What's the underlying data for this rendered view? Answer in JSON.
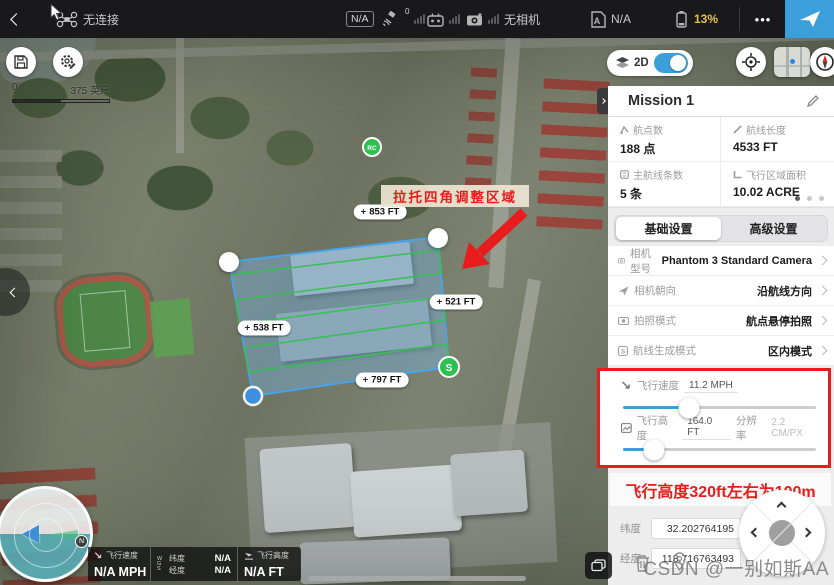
{
  "top_bar": {
    "connection": "无连接",
    "mode_badge": "N/A",
    "gps_count": "0",
    "camera_status": "无相机",
    "flight_mode": "N/A",
    "battery": "13%",
    "more": "•••"
  },
  "map": {
    "scale_start": "0",
    "scale_end": "375 英尺",
    "toggle_2d": "2D",
    "move_icon": "+",
    "labels": {
      "top": "853 FT",
      "right": "521 FT",
      "left": "538 FT",
      "bottom": "797 FT"
    },
    "annotation": "拉托四角调整区域",
    "rc_marker": "RC",
    "start_marker": "S",
    "north_badge": "N"
  },
  "panel": {
    "mission_title": "Mission 1",
    "stats": [
      {
        "label": "航点数",
        "value": "188 点"
      },
      {
        "label": "航线长度",
        "value": "4533 FT"
      },
      {
        "label": "主航线条数",
        "value": "5 条"
      },
      {
        "label": "飞行区域面积",
        "value": "10.02 ACRE"
      }
    ],
    "tabs": [
      {
        "label": "基础设置"
      },
      {
        "label": "高级设置"
      }
    ],
    "settings": [
      {
        "label": "相机型号",
        "value": "Phantom 3 Standard Camera"
      },
      {
        "label": "相机朝向",
        "value": "沿航线方向"
      },
      {
        "label": "拍照模式",
        "value": "航点悬停拍照"
      },
      {
        "label": "航线生成模式",
        "value": "区内模式"
      }
    ],
    "speed": {
      "label": "飞行速度",
      "value": "11.2 MPH",
      "percent": 34
    },
    "altitude": {
      "label": "飞行高度",
      "value": "164.0 FT",
      "res_label": "分辨率",
      "res_value": "2.2 CM/PX",
      "percent": 16
    },
    "note": "飞行高度320ft左右为100m",
    "coords": [
      {
        "label": "纬度",
        "value": "32.202764195"
      },
      {
        "label": "经度",
        "value": "118.716763493"
      }
    ]
  },
  "telemetry": {
    "speed_label": "飞行速度",
    "speed_value": "N/A MPH",
    "wgs": "WGS",
    "lat_label": "纬度",
    "lat_value": "N/A",
    "lng_label": "经度",
    "lng_value": "N/A",
    "alt_label": "飞行高度",
    "alt_value": "N/A FT"
  },
  "watermark": "CSDN @一别如斯AA",
  "colors": {
    "accent": "#3ba0d9",
    "red": "#e81c1c",
    "battery_yellow": "#e3c24b",
    "polygon_blue": "#4aa3e8",
    "path_green": "#35c24f",
    "handle_blue": "#3f8fe0",
    "marker_green": "#2fbf53"
  }
}
